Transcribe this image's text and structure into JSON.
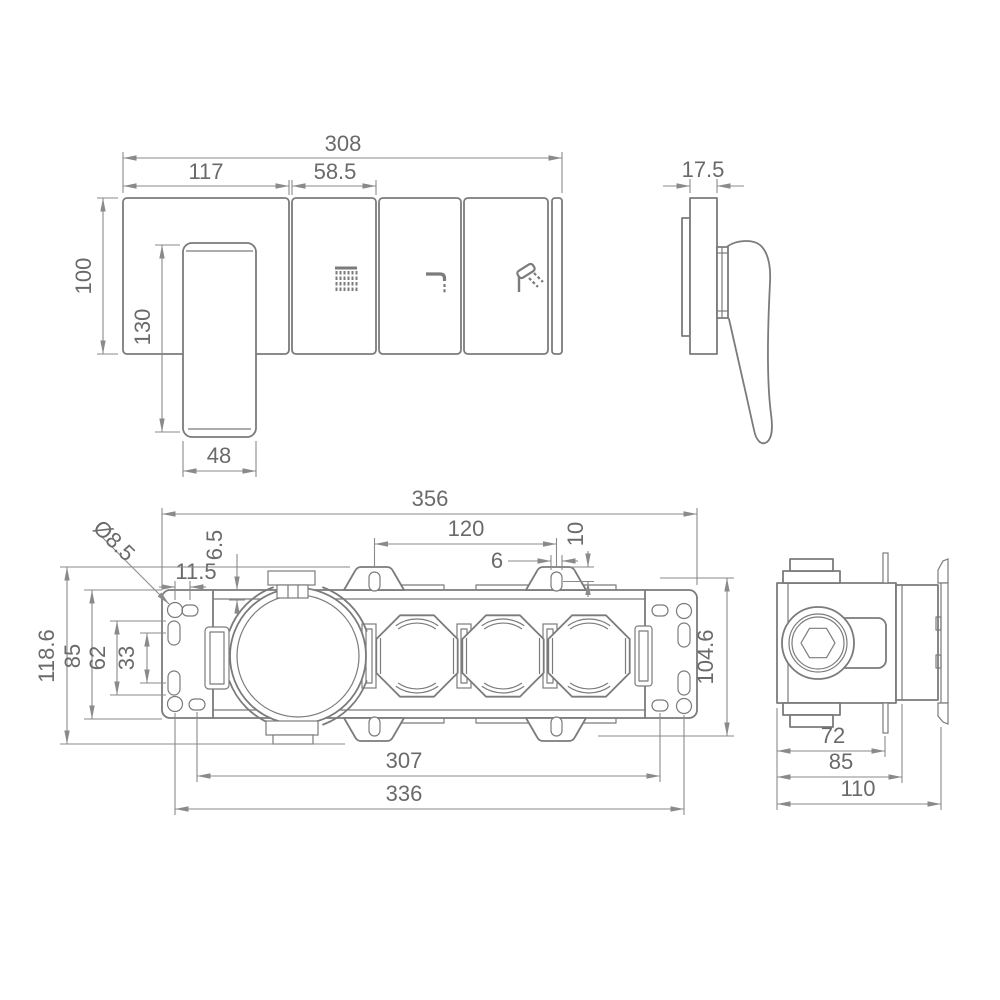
{
  "drawing_title": "shower mixer trim and rough-in valve dimensional drawing",
  "colors": {
    "line": "#7b7b7b",
    "dimension": "#8a8a8a",
    "text": "#6a6a6a",
    "background": "#ffffff"
  },
  "views": {
    "trim_front": {
      "dims": {
        "overall_width": "308",
        "left_plate_width": "117",
        "button_plate_width": "58.5",
        "plate_height": "100",
        "handle_length": "130",
        "handle_width": "48"
      },
      "buttons": [
        "rain-shower",
        "spout",
        "hand-shower"
      ]
    },
    "trim_side": {
      "dims": {
        "plate_thickness": "17.5"
      }
    },
    "rough_in_front": {
      "dims": {
        "overall_width": "356",
        "mounting_hole_diameter": "Ø8.5",
        "rail_flange_height": "6.5",
        "bracket_hole_offset": "11.5",
        "tab_hole_spacing": "120",
        "tab_hole_height": "10",
        "tab_hole_width": "6",
        "overall_height": "118.6",
        "bracket_height": "85",
        "slot_outer_span": "62",
        "slot_center_spacing": "33",
        "tab_hole_vertical_spacing": "104.6",
        "slot_center_span": "307",
        "hole_center_span": "336"
      }
    },
    "rough_in_side": {
      "dims": {
        "body_depth": "72",
        "box_depth": "85",
        "overall_depth": "110"
      }
    }
  }
}
